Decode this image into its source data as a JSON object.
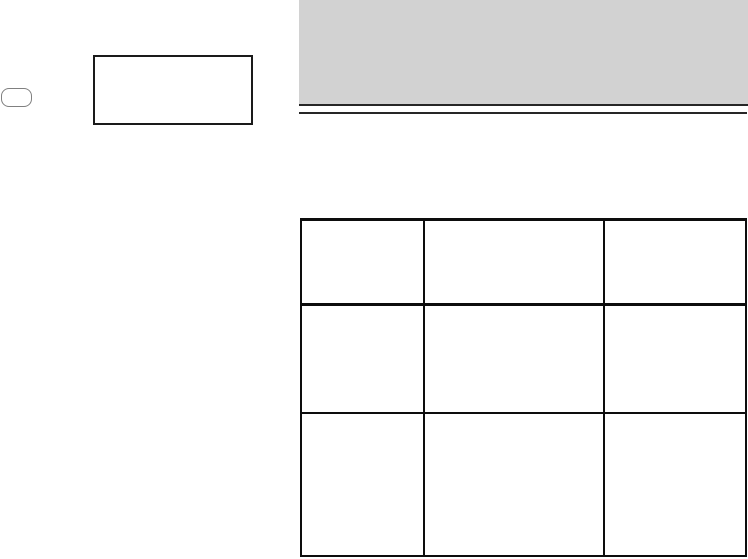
{
  "colors": {
    "page-bg": "#ffffff",
    "band-fill": "#d2d2d2",
    "rule-color": "#262626",
    "table-border": "#0d0d0d",
    "box-border": "#1a1a1a",
    "pill-border": "#808080"
  },
  "header_band": {
    "label": ""
  },
  "pill": {
    "label": ""
  },
  "placeholder_box": {
    "label": ""
  },
  "table": {
    "columns": 3,
    "rows": [
      [
        "",
        "",
        ""
      ],
      [
        "",
        "",
        ""
      ],
      [
        "",
        "",
        ""
      ]
    ]
  }
}
